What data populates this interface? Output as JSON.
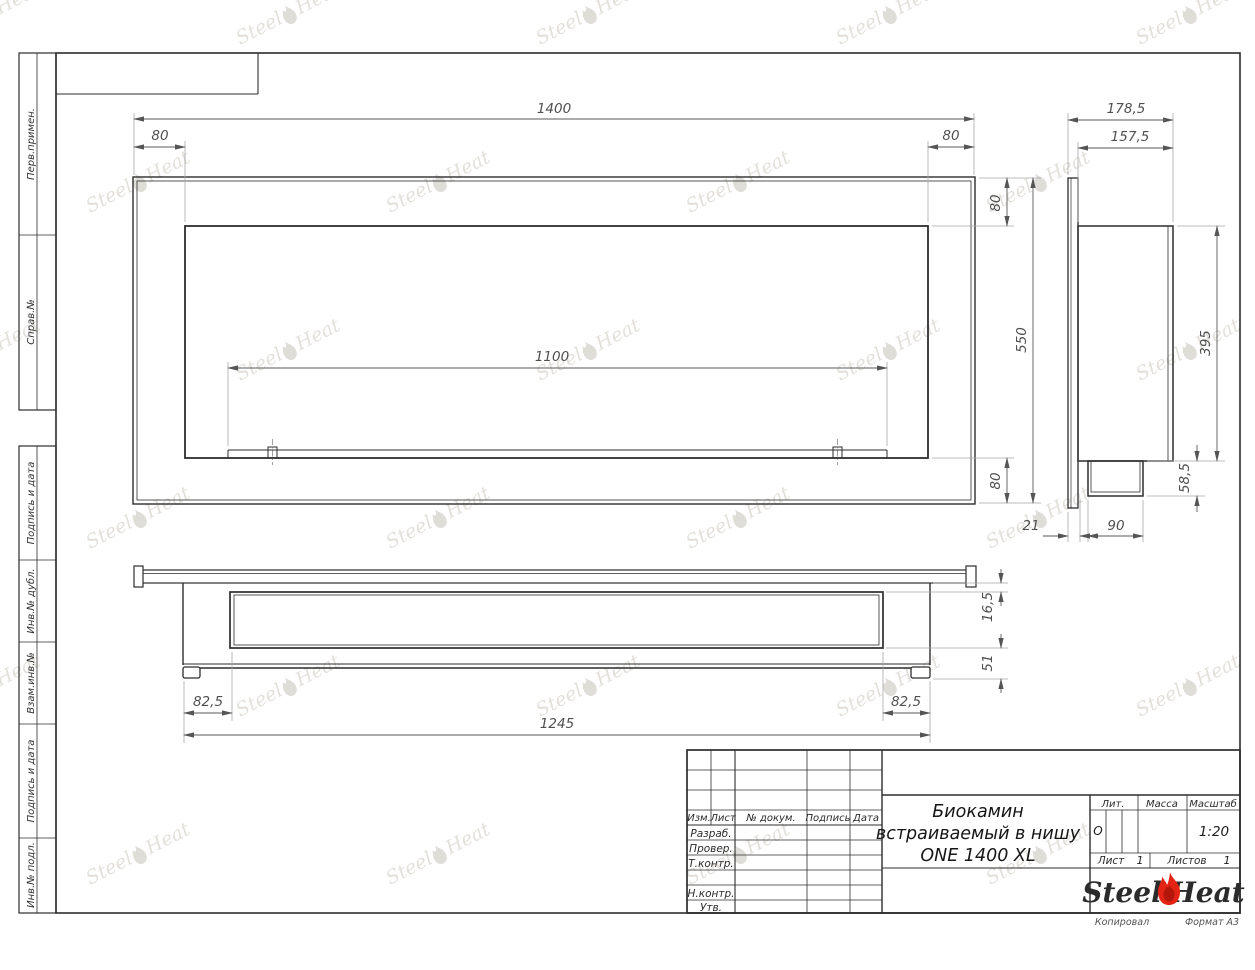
{
  "watermark": {
    "steel": "Steel",
    "heat": "Heat"
  },
  "margin": {
    "labels": [
      "Перв.примен.",
      "Справ.№",
      "Подпись и дата",
      "Инв.№ дубл.",
      "Взам.инв.№",
      "Подпись и дата",
      "Инв.№ подл."
    ]
  },
  "views": {
    "front": {
      "width": "1400",
      "offset_left": "80",
      "offset_right": "80",
      "offset_top": "80",
      "offset_bottom": "80",
      "opening_width": "1100",
      "height": "550"
    },
    "side": {
      "total_depth": "178,5",
      "body_depth": "157,5",
      "niche_height": "395",
      "burner_box_height": "58,5",
      "flange_offset": "21",
      "burner_box_depth": "90"
    },
    "plan": {
      "flange_depth": "16,5",
      "rear_depth": "51",
      "offset_left": "82,5",
      "offset_right": "82,5",
      "mount_width": "1245"
    }
  },
  "title_block": {
    "columns": {
      "izm": "Изм.",
      "list": "Лист",
      "doc": "№ докум.",
      "sign": "Подпись",
      "date": "Дата"
    },
    "rows": {
      "developed": "Разраб.",
      "checked": "Провер.",
      "tcontrol": "Т.контр.",
      "ncontrol": "Н.контр.",
      "approved": "Утв."
    },
    "title_line1": "Биокамин",
    "title_line2": "встраиваемый в нишу",
    "title_line3": "ONE 1400 XL",
    "lit_label": "Лит.",
    "lit_value": "О",
    "mass_label": "Масса",
    "scale_label": "Масштаб",
    "scale_value": "1:20",
    "sheet_label": "Лист",
    "sheet_value": "1",
    "sheets_label": "Листов",
    "sheets_value": "1",
    "logo_steel": "Steel",
    "logo_heat": "Heat"
  },
  "footer": {
    "copied": "Копировал",
    "format": "Формат А3"
  }
}
